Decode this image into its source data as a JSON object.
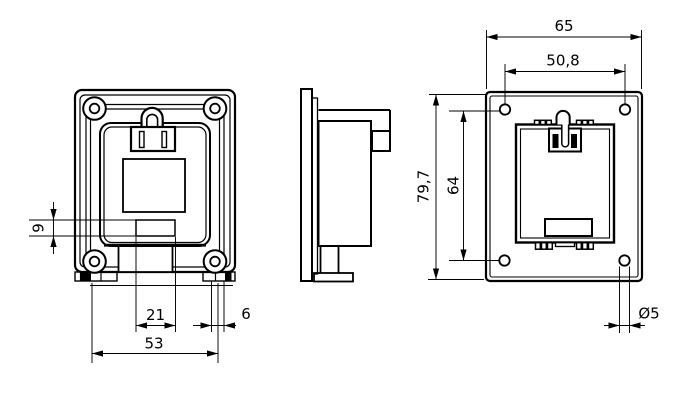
{
  "drawing": {
    "type": "technical-orthographic-drawing",
    "views": {
      "front": "front view with latch, window and mounting feet",
      "side": "side profile view",
      "rear": "rear mounting-plate view"
    },
    "dimensions": {
      "front": {
        "d9": "9",
        "d21": "21",
        "d6": "6",
        "d53": "53"
      },
      "rear": {
        "d65": "65",
        "d50_8": "50,8",
        "d79_7": "79,7",
        "d64": "64",
        "dia5": "Ø5"
      }
    },
    "colors": {
      "line": "#000000",
      "background": "#ffffff"
    }
  }
}
